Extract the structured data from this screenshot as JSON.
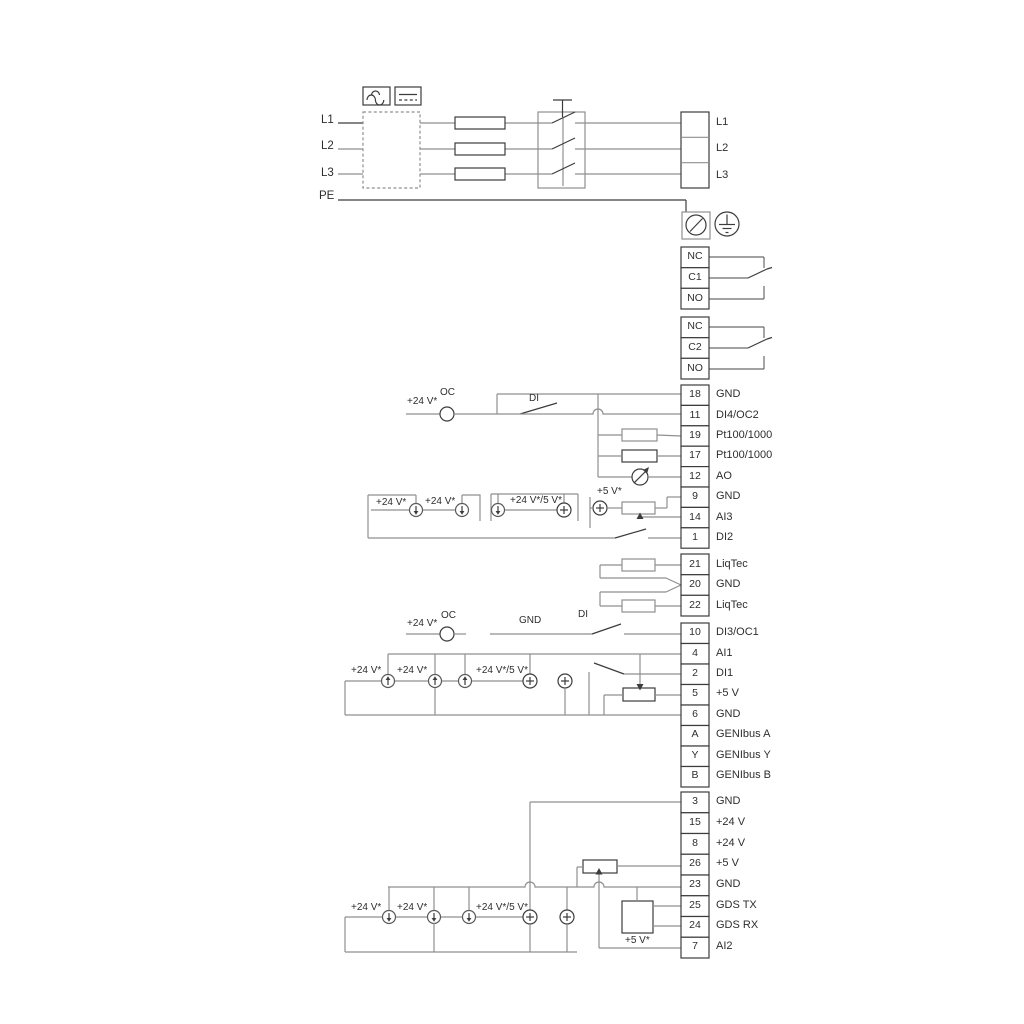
{
  "diagram": {
    "mains_in": [
      "L1",
      "L2",
      "L3",
      "PE"
    ],
    "mains_out": [
      "L1",
      "L2",
      "L3"
    ],
    "relay1": {
      "rows": [
        "NC",
        "C1",
        "NO"
      ]
    },
    "relay2": {
      "rows": [
        "NC",
        "C2",
        "NO"
      ]
    },
    "io1": {
      "rows": [
        {
          "num": "18",
          "label": "GND"
        },
        {
          "num": "11",
          "label": "DI4/OC2"
        },
        {
          "num": "19",
          "label": "Pt100/1000"
        },
        {
          "num": "17",
          "label": "Pt100/1000"
        },
        {
          "num": "12",
          "label": "AO"
        },
        {
          "num": "9",
          "label": "GND"
        },
        {
          "num": "14",
          "label": "AI3"
        },
        {
          "num": "1",
          "label": "DI2"
        }
      ]
    },
    "liqtec": {
      "rows": [
        {
          "num": "21",
          "label": "LiqTec"
        },
        {
          "num": "20",
          "label": "GND"
        },
        {
          "num": "22",
          "label": "LiqTec"
        }
      ]
    },
    "io2": {
      "rows": [
        {
          "num": "10",
          "label": "DI3/OC1"
        },
        {
          "num": "4",
          "label": "AI1"
        },
        {
          "num": "2",
          "label": "DI1"
        },
        {
          "num": "5",
          "label": "+5 V"
        },
        {
          "num": "6",
          "label": "GND"
        },
        {
          "num": "A",
          "label": "GENIbus A"
        },
        {
          "num": "Y",
          "label": "GENIbus Y"
        },
        {
          "num": "B",
          "label": "GENIbus B"
        }
      ]
    },
    "io3": {
      "rows": [
        {
          "num": "3",
          "label": "GND"
        },
        {
          "num": "15",
          "label": "+24 V"
        },
        {
          "num": "8",
          "label": "+24 V"
        },
        {
          "num": "26",
          "label": "+5 V"
        },
        {
          "num": "23",
          "label": "GND"
        },
        {
          "num": "25",
          "label": "GDS TX"
        },
        {
          "num": "24",
          "label": "GDS RX"
        },
        {
          "num": "7",
          "label": "AI2"
        }
      ]
    },
    "labels": {
      "plus24": "+24 V*",
      "oc": "OC",
      "di": "DI",
      "gnd": "GND",
      "plus24_5": "+24 V*/5 V*",
      "plus5": "+5 V*"
    },
    "colors": {
      "wire_gray": "#8f8f8f",
      "wire_dark": "#3c3c3c",
      "text": "#2e2e2e",
      "background": "#ffffff"
    }
  }
}
